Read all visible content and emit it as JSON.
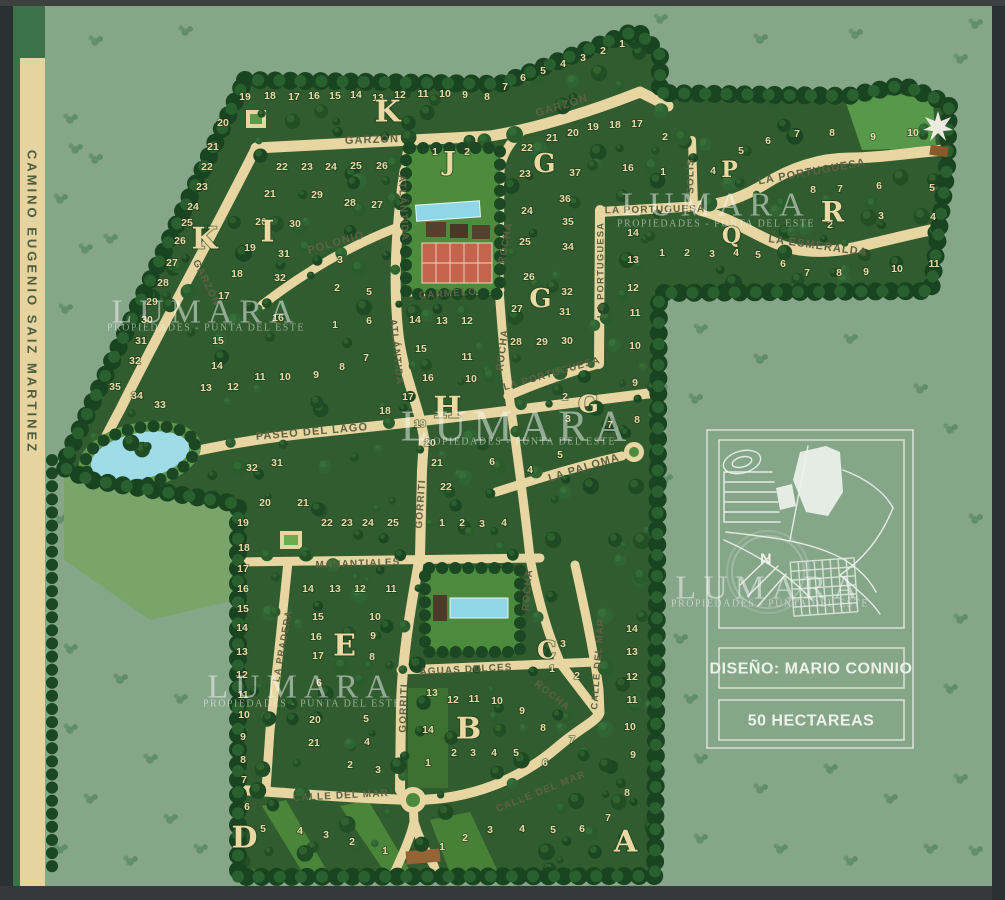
{
  "page": {
    "title_road": "CAMINO EUGENIO SAIZ MARTINEZ"
  },
  "watermark": {
    "title": "LUMARA",
    "subtitle": "PROPIEDADES - PUNTA DEL ESTE",
    "instances": [
      {
        "x": 206,
        "y": 312,
        "sy": 328,
        "size": 34
      },
      {
        "x": 716,
        "y": 205,
        "sy": 224,
        "size": 34
      },
      {
        "x": 517,
        "y": 426,
        "sy": 442,
        "size": 44
      },
      {
        "x": 770,
        "y": 588,
        "sy": 604,
        "size": 34
      },
      {
        "x": 302,
        "y": 687,
        "sy": 704,
        "size": 34
      }
    ]
  },
  "panel": {
    "design": "DISEÑO: MARIO CONNIO",
    "area": "50 HECTAREAS",
    "compass": "N"
  },
  "map": {
    "sections": [
      [
        "K",
        388,
        112,
        30
      ],
      [
        "K",
        205,
        239,
        30
      ],
      [
        "I",
        268,
        232,
        30
      ],
      [
        "J",
        450,
        162,
        26
      ],
      [
        "G",
        545,
        164,
        26
      ],
      [
        "G",
        541,
        299,
        26
      ],
      [
        "G",
        589,
        404,
        24
      ],
      [
        "H",
        448,
        408,
        30
      ],
      [
        "P",
        730,
        170,
        22
      ],
      [
        "Q",
        732,
        236,
        22
      ],
      [
        "R",
        833,
        212,
        28
      ],
      [
        "E",
        345,
        646,
        30
      ],
      [
        "C",
        547,
        650,
        24
      ],
      [
        "B",
        469,
        729,
        30
      ],
      [
        "D",
        245,
        838,
        30
      ],
      [
        "A",
        626,
        842,
        30
      ]
    ],
    "streets": [
      {
        "name": "GARZÓN",
        "x": 372,
        "y": 140,
        "a": -2,
        "s": 11
      },
      {
        "name": "GARZÓN",
        "x": 562,
        "y": 106,
        "a": -17,
        "s": 11
      },
      {
        "name": "GARZÓN",
        "x": 206,
        "y": 283,
        "a": 64,
        "s": 10
      },
      {
        "name": "POLONIO",
        "x": 336,
        "y": 243,
        "a": -16,
        "s": 11
      },
      {
        "name": "ATLÁNTIDA",
        "x": 403,
        "y": 208,
        "a": 87,
        "s": 10
      },
      {
        "name": "ATLÁNTIDA",
        "x": 396,
        "y": 352,
        "a": 84,
        "s": 10
      },
      {
        "name": "ROCHA",
        "x": 506,
        "y": 243,
        "a": -80,
        "s": 10
      },
      {
        "name": "ROCHA",
        "x": 503,
        "y": 350,
        "a": -83,
        "s": 10
      },
      {
        "name": "ROCHA",
        "x": 528,
        "y": 590,
        "a": -85,
        "s": 10
      },
      {
        "name": "ROCHA",
        "x": 552,
        "y": 696,
        "a": 38,
        "s": 10
      },
      {
        "name": "CARMELO",
        "x": 448,
        "y": 294,
        "a": -4,
        "s": 10
      },
      {
        "name": "LA PORTUGUESA",
        "x": 655,
        "y": 210,
        "a": -1,
        "s": 10
      },
      {
        "name": "LA PORTUGUESA",
        "x": 601,
        "y": 270,
        "a": -90,
        "s": 9.5
      },
      {
        "name": "LA PORTUGUESA",
        "x": 552,
        "y": 374,
        "a": -16,
        "s": 10
      },
      {
        "name": "LA PORTUGUESA",
        "x": 812,
        "y": 172,
        "a": -10,
        "s": 11
      },
      {
        "name": "LA ESMERALDA",
        "x": 818,
        "y": 246,
        "a": 8,
        "s": 11
      },
      {
        "name": "SOLÍS",
        "x": 691,
        "y": 176,
        "a": -90,
        "s": 10
      },
      {
        "name": "PASEO DEL LAGO",
        "x": 312,
        "y": 432,
        "a": -5,
        "s": 11
      },
      {
        "name": "LA PALOMA",
        "x": 584,
        "y": 468,
        "a": -17,
        "s": 11
      },
      {
        "name": "MANANTIALES",
        "x": 358,
        "y": 564,
        "a": -2,
        "s": 10
      },
      {
        "name": "GORRITI",
        "x": 421,
        "y": 504,
        "a": -86,
        "s": 10
      },
      {
        "name": "GORRITI",
        "x": 404,
        "y": 708,
        "a": -88,
        "s": 10
      },
      {
        "name": "LA PRADERA",
        "x": 283,
        "y": 646,
        "a": -80,
        "s": 9.5
      },
      {
        "name": "AGUAS DULCES",
        "x": 466,
        "y": 670,
        "a": -3,
        "s": 10
      },
      {
        "name": "CALLE DEL MAR",
        "x": 341,
        "y": 796,
        "a": -3,
        "s": 10
      },
      {
        "name": "CALLE DEL MAR",
        "x": 541,
        "y": 792,
        "a": -22,
        "s": 10
      },
      {
        "name": "CALLE DEL MAR",
        "x": 598,
        "y": 664,
        "a": -86,
        "s": 9.5
      }
    ],
    "lots": [
      [
        19,
        245,
        97
      ],
      [
        18,
        270,
        96
      ],
      [
        17,
        294,
        97
      ],
      [
        16,
        314,
        96
      ],
      [
        15,
        335,
        96
      ],
      [
        14,
        356,
        95
      ],
      [
        13,
        378,
        98
      ],
      [
        12,
        400,
        95
      ],
      [
        11,
        423,
        94
      ],
      [
        10,
        445,
        94
      ],
      [
        9,
        465,
        95
      ],
      [
        8,
        487,
        97
      ],
      [
        7,
        505,
        87
      ],
      [
        6,
        523,
        78
      ],
      [
        5,
        543,
        71
      ],
      [
        4,
        563,
        64
      ],
      [
        3,
        583,
        58
      ],
      [
        2,
        603,
        51
      ],
      [
        1,
        622,
        44
      ],
      [
        20,
        223,
        123
      ],
      [
        21,
        213,
        147
      ],
      [
        22,
        207,
        167
      ],
      [
        23,
        202,
        187
      ],
      [
        24,
        193,
        207
      ],
      [
        25,
        187,
        223
      ],
      [
        26,
        180,
        241
      ],
      [
        27,
        172,
        263
      ],
      [
        28,
        163,
        283
      ],
      [
        29,
        152,
        302
      ],
      [
        30,
        147,
        320
      ],
      [
        31,
        141,
        341
      ],
      [
        32,
        135,
        361
      ],
      [
        35,
        115,
        387
      ],
      [
        34,
        137,
        396
      ],
      [
        33,
        160,
        405
      ],
      [
        22,
        282,
        167
      ],
      [
        23,
        307,
        167
      ],
      [
        24,
        331,
        167
      ],
      [
        25,
        356,
        166
      ],
      [
        26,
        382,
        166
      ],
      [
        21,
        270,
        194
      ],
      [
        29,
        317,
        195
      ],
      [
        28,
        350,
        203
      ],
      [
        27,
        377,
        205
      ],
      [
        20,
        261,
        222
      ],
      [
        30,
        295,
        224
      ],
      [
        19,
        250,
        248
      ],
      [
        31,
        284,
        254
      ],
      [
        18,
        237,
        274
      ],
      [
        32,
        280,
        278
      ],
      [
        17,
        224,
        296
      ],
      [
        16,
        278,
        318
      ],
      [
        15,
        218,
        341
      ],
      [
        14,
        217,
        366
      ],
      [
        13,
        206,
        388
      ],
      [
        12,
        233,
        387
      ],
      [
        11,
        260,
        377
      ],
      [
        10,
        285,
        377
      ],
      [
        9,
        316,
        375
      ],
      [
        3,
        340,
        260
      ],
      [
        2,
        337,
        288
      ],
      [
        1,
        335,
        325
      ],
      [
        5,
        369,
        292
      ],
      [
        6,
        369,
        321
      ],
      [
        7,
        366,
        358
      ],
      [
        8,
        342,
        367
      ],
      [
        14,
        415,
        320
      ],
      [
        15,
        421,
        349
      ],
      [
        17,
        408,
        397
      ],
      [
        18,
        385,
        411
      ],
      [
        19,
        420,
        424
      ],
      [
        13,
        442,
        321
      ],
      [
        12,
        467,
        321
      ],
      [
        11,
        467,
        357
      ],
      [
        10,
        471,
        379
      ],
      [
        16,
        428,
        378
      ],
      [
        20,
        430,
        443
      ],
      [
        21,
        437,
        463
      ],
      [
        22,
        446,
        487
      ],
      [
        2,
        565,
        397
      ],
      [
        3,
        568,
        419
      ],
      [
        5,
        560,
        455
      ],
      [
        6,
        492,
        462
      ],
      [
        4,
        530,
        470
      ],
      [
        27,
        517,
        309
      ],
      [
        32,
        567,
        292
      ],
      [
        31,
        565,
        312
      ],
      [
        28,
        516,
        342
      ],
      [
        29,
        542,
        342
      ],
      [
        30,
        567,
        341
      ],
      [
        12,
        633,
        288
      ],
      [
        11,
        635,
        313
      ],
      [
        10,
        635,
        346
      ],
      [
        9,
        635,
        383
      ],
      [
        8,
        637,
        420
      ],
      [
        7,
        610,
        425
      ],
      [
        21,
        552,
        138
      ],
      [
        20,
        573,
        133
      ],
      [
        19,
        593,
        127
      ],
      [
        18,
        615,
        125
      ],
      [
        17,
        637,
        124
      ],
      [
        22,
        527,
        148
      ],
      [
        23,
        525,
        174
      ],
      [
        37,
        575,
        173
      ],
      [
        36,
        565,
        199
      ],
      [
        24,
        527,
        211
      ],
      [
        35,
        568,
        222
      ],
      [
        25,
        525,
        242
      ],
      [
        34,
        568,
        247
      ],
      [
        26,
        529,
        277
      ],
      [
        16,
        628,
        168
      ],
      [
        1,
        663,
        172
      ],
      [
        2,
        665,
        137
      ],
      [
        14,
        633,
        233
      ],
      [
        13,
        633,
        260
      ],
      [
        5,
        741,
        151
      ],
      [
        6,
        768,
        141
      ],
      [
        7,
        797,
        134
      ],
      [
        8,
        832,
        133
      ],
      [
        9,
        873,
        137
      ],
      [
        10,
        913,
        133
      ],
      [
        4,
        713,
        171
      ],
      [
        8,
        813,
        190
      ],
      [
        7,
        840,
        189
      ],
      [
        6,
        879,
        186
      ],
      [
        5,
        932,
        188
      ],
      [
        2,
        830,
        225
      ],
      [
        3,
        881,
        216
      ],
      [
        4,
        933,
        217
      ],
      [
        1,
        662,
        253
      ],
      [
        2,
        687,
        253
      ],
      [
        3,
        712,
        254
      ],
      [
        4,
        736,
        253
      ],
      [
        5,
        758,
        255
      ],
      [
        6,
        783,
        264
      ],
      [
        7,
        807,
        273
      ],
      [
        8,
        839,
        273
      ],
      [
        9,
        866,
        272
      ],
      [
        10,
        897,
        269
      ],
      [
        11,
        934,
        264
      ],
      [
        1,
        435,
        152
      ],
      [
        2,
        467,
        152
      ],
      [
        32,
        252,
        468
      ],
      [
        31,
        277,
        463
      ],
      [
        20,
        265,
        503
      ],
      [
        21,
        303,
        503
      ],
      [
        22,
        327,
        523
      ],
      [
        23,
        347,
        523
      ],
      [
        24,
        368,
        523
      ],
      [
        25,
        393,
        523
      ],
      [
        19,
        243,
        523
      ],
      [
        18,
        244,
        548
      ],
      [
        17,
        243,
        569
      ],
      [
        16,
        243,
        589
      ],
      [
        15,
        243,
        609
      ],
      [
        14,
        242,
        628
      ],
      [
        13,
        242,
        652
      ],
      [
        12,
        242,
        675
      ],
      [
        11,
        243,
        695
      ],
      [
        10,
        244,
        715
      ],
      [
        9,
        243,
        737
      ],
      [
        8,
        243,
        760
      ],
      [
        7,
        244,
        780
      ],
      [
        14,
        308,
        589
      ],
      [
        13,
        335,
        589
      ],
      [
        12,
        360,
        589
      ],
      [
        11,
        391,
        589
      ],
      [
        15,
        318,
        617
      ],
      [
        10,
        375,
        617
      ],
      [
        16,
        316,
        637
      ],
      [
        9,
        373,
        636
      ],
      [
        17,
        318,
        656
      ],
      [
        8,
        372,
        657
      ],
      [
        6,
        319,
        683
      ],
      [
        5,
        366,
        719
      ],
      [
        20,
        315,
        720
      ],
      [
        21,
        314,
        743
      ],
      [
        4,
        367,
        742
      ],
      [
        2,
        350,
        765
      ],
      [
        3,
        378,
        770
      ],
      [
        1,
        442,
        523
      ],
      [
        2,
        462,
        523
      ],
      [
        3,
        482,
        524
      ],
      [
        4,
        504,
        523
      ],
      [
        13,
        432,
        693
      ],
      [
        12,
        453,
        700
      ],
      [
        11,
        474,
        699
      ],
      [
        10,
        497,
        701
      ],
      [
        9,
        522,
        711
      ],
      [
        8,
        543,
        728
      ],
      [
        7,
        572,
        740
      ],
      [
        6,
        545,
        763
      ],
      [
        14,
        428,
        730
      ],
      [
        1,
        428,
        763
      ],
      [
        2,
        454,
        753
      ],
      [
        3,
        473,
        753
      ],
      [
        4,
        494,
        753
      ],
      [
        5,
        516,
        753
      ],
      [
        3,
        563,
        644
      ],
      [
        1,
        552,
        669
      ],
      [
        2,
        577,
        676
      ],
      [
        14,
        632,
        629
      ],
      [
        13,
        632,
        652
      ],
      [
        12,
        632,
        677
      ],
      [
        11,
        632,
        700
      ],
      [
        10,
        630,
        727
      ],
      [
        9,
        633,
        755
      ],
      [
        8,
        627,
        793
      ],
      [
        7,
        608,
        818
      ],
      [
        1,
        442,
        847
      ],
      [
        2,
        465,
        838
      ],
      [
        3,
        490,
        830
      ],
      [
        4,
        522,
        829
      ],
      [
        5,
        553,
        830
      ],
      [
        6,
        582,
        829
      ],
      [
        5,
        263,
        829
      ],
      [
        4,
        300,
        831
      ],
      [
        3,
        326,
        835
      ],
      [
        2,
        352,
        842
      ],
      [
        1,
        385,
        851
      ],
      [
        6,
        247,
        807
      ]
    ]
  }
}
